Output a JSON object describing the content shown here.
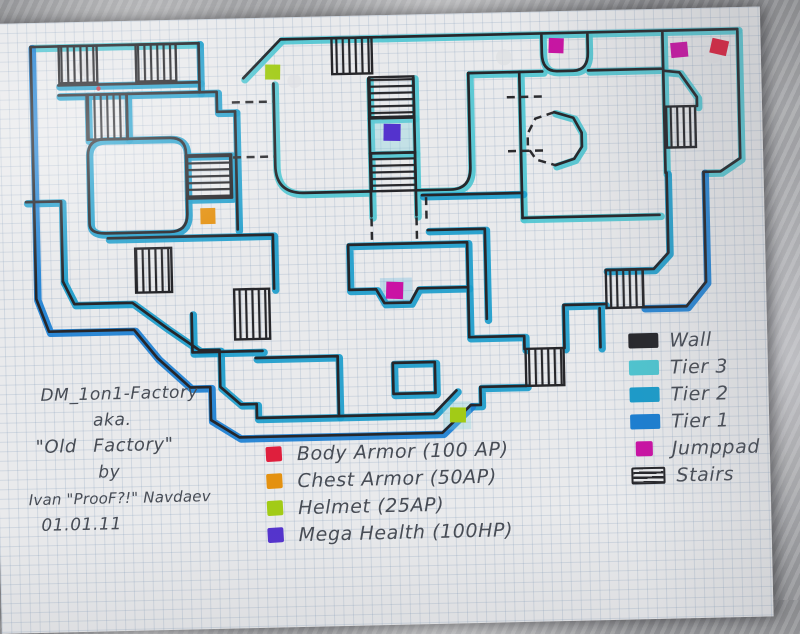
{
  "map": {
    "name": "DM_1on1-Factory hand-drawn level map",
    "title_block": {
      "lines": [
        "DM_1on1-Factory",
        "aka.",
        "\"Old Factory\"",
        "by",
        "Ivan \"ProoF?!\" Navdaev",
        "01.01.11"
      ]
    },
    "tier_colors": {
      "wall": "#26262a",
      "tier3": "#4fc6d1",
      "tier2": "#1b9ccb",
      "tier1": "#1b7fd2"
    },
    "item_colors": {
      "body_armor": "#df1f3d",
      "chest_armor": "#e49110",
      "helmet": "#a2cb16",
      "mega_health": "#5433cd",
      "jumppad": "#ca12a4"
    },
    "legend": {
      "items": [
        {
          "label": "Wall",
          "type": "swatch",
          "color": "#26262a"
        },
        {
          "label": "Tier 3",
          "type": "swatch",
          "color": "#4fc6d1"
        },
        {
          "label": "Tier 2",
          "type": "swatch",
          "color": "#1b9ccb"
        },
        {
          "label": "Tier 1",
          "type": "swatch",
          "color": "#1b7fd2"
        },
        {
          "label": "Jumppad",
          "type": "swatch-small",
          "color": "#ca12a4"
        },
        {
          "label": "Stairs",
          "type": "stairs-icon"
        }
      ]
    },
    "item_legend": {
      "items": [
        {
          "label": "Body Armor (100 AP)",
          "color": "#df1f3d"
        },
        {
          "label": "Chest Armor (50AP)",
          "color": "#e49110"
        },
        {
          "label": "Helmet (25AP)",
          "color": "#a2cb16"
        },
        {
          "label": "Mega Health (100HP)",
          "color": "#5433cd"
        }
      ]
    },
    "markers": [
      {
        "name": "jumppad",
        "x": 548,
        "y": 51,
        "w": 15,
        "h": 15,
        "rot": 3,
        "color": "jumppad"
      },
      {
        "name": "jumppad",
        "x": 670,
        "y": 58,
        "w": 17,
        "h": 15,
        "rot": -4,
        "color": "jumppad"
      },
      {
        "name": "body-armor",
        "x": 710,
        "y": 56,
        "w": 17,
        "h": 15,
        "rot": 14,
        "color": "body_armor"
      },
      {
        "name": "helmet",
        "x": 264,
        "y": 71,
        "w": 15,
        "h": 15,
        "rot": 2,
        "color": "helmet"
      },
      {
        "name": "mega-health",
        "x": 381,
        "y": 133,
        "w": 17,
        "h": 17,
        "rot": 2,
        "color": "mega_health"
      },
      {
        "name": "chest-armor",
        "x": 196,
        "y": 213,
        "w": 15,
        "h": 16,
        "rot": 0,
        "color": "chest_armor"
      },
      {
        "name": "jumppad",
        "x": 380,
        "y": 291,
        "w": 17,
        "h": 17,
        "rot": 3,
        "color": "jumppad"
      },
      {
        "name": "helmet",
        "x": 441,
        "y": 418,
        "w": 16,
        "h": 15,
        "rot": 2,
        "color": "helmet"
      }
    ]
  }
}
